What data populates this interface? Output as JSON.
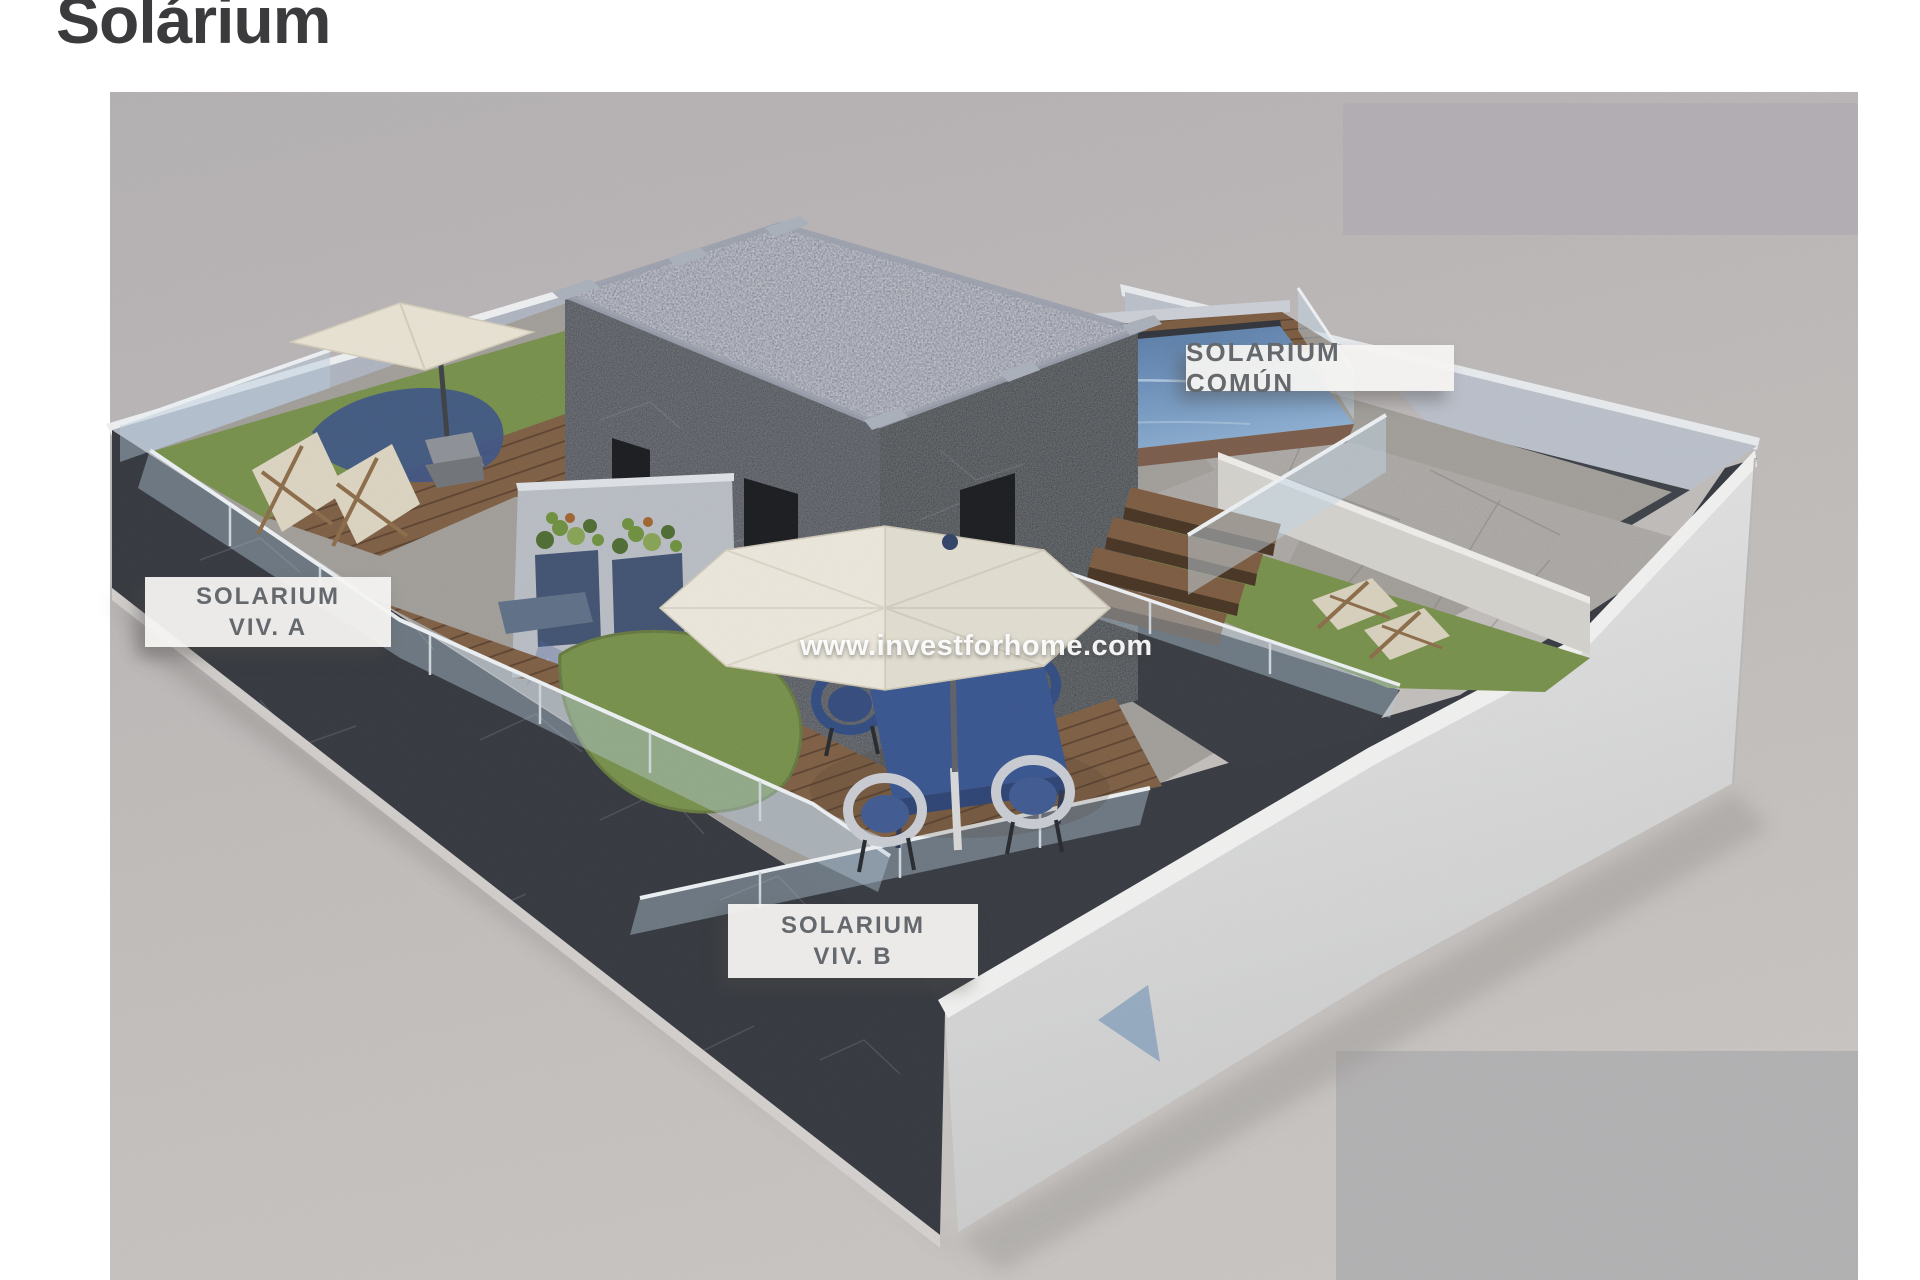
{
  "page": {
    "title": "Solárium"
  },
  "labels": {
    "comun": "SOLARIUM COMÚN",
    "viv_a_line1": "SOLARIUM",
    "viv_a_line2": "VIV. A",
    "viv_b_line1": "SOLARIUM",
    "viv_b_line2": "VIV. B"
  },
  "watermark": "www.investforhome.com",
  "colors": {
    "page_bg": "#ffffff",
    "photo_bg_top": "#b4b0b3",
    "photo_bg_bottom": "#cbc7c3",
    "neighbor_block": "#b1adb3",
    "dark_wall": "#33373d",
    "white_wall": "#e6e6e5",
    "wood_deck": "#7d5d41",
    "grass": "#6f8b41",
    "pool_water": "#5f82ab",
    "umbrella_canvas": "#ece8dc",
    "table_blue": "#36538f",
    "label_bg": "#f4f3f1",
    "label_text": "#65696d"
  }
}
